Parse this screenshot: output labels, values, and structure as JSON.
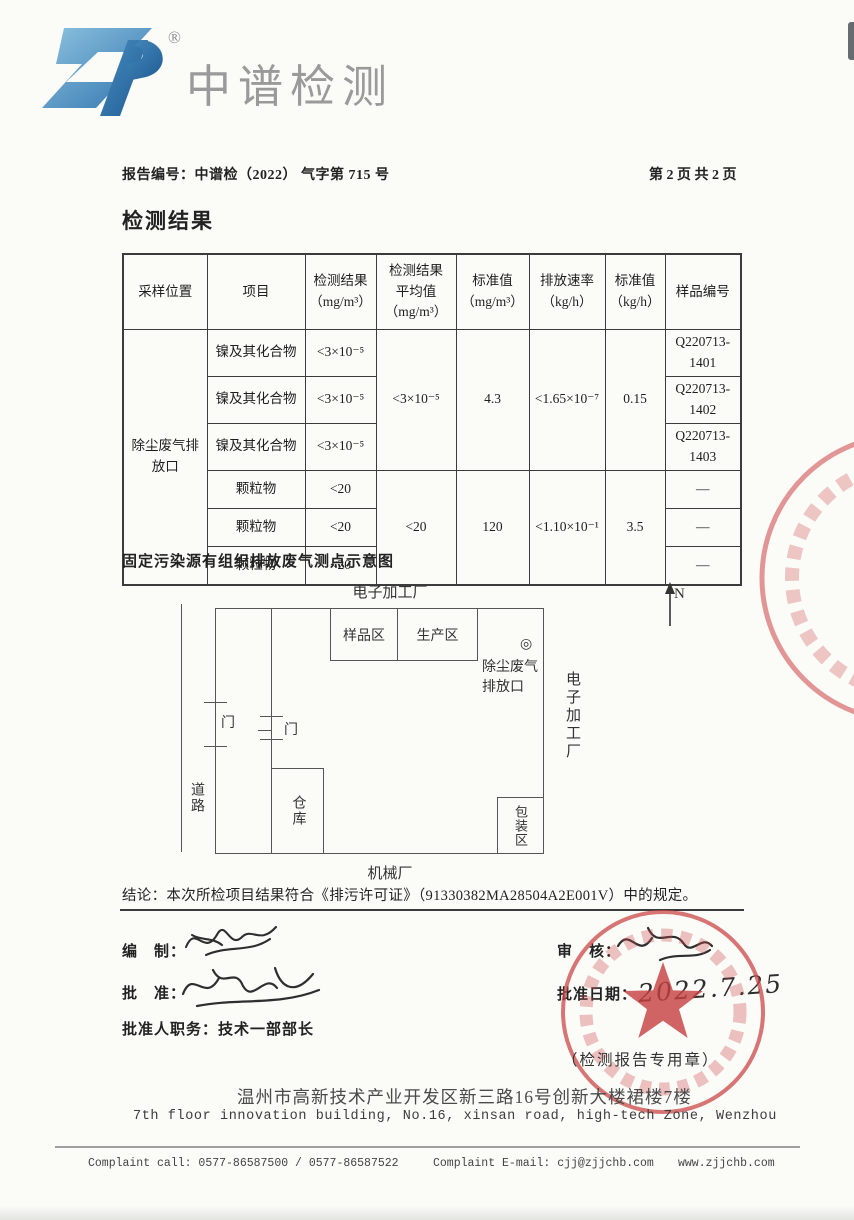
{
  "brand": {
    "name": "中谱检测",
    "registered_mark": "®"
  },
  "header": {
    "report_no": "报告编号：中谱检（2022） 气字第 715 号",
    "page_info": "第 2 页 共 2 页"
  },
  "results": {
    "title": "检测结果"
  },
  "results_table": {
    "headers": {
      "location": "采样位置",
      "item": "项目",
      "result_l1": "检测结果",
      "result_l2": "（mg/m³）",
      "avg_l1": "检测结果",
      "avg_l2": "平均值",
      "avg_l3": "（mg/m³）",
      "std_mg_l1": "标准值",
      "std_mg_l2": "（mg/m³）",
      "rate_l1": "排放速率",
      "rate_l2": "（kg/h）",
      "std_kg_l1": "标准值",
      "std_kg_l2": "（kg/h）",
      "sample": "样品编号"
    },
    "location": "除尘废气排放口",
    "groups": [
      {
        "item": "镍及其化合物",
        "results": [
          "<3×10⁻⁵",
          "<3×10⁻⁵",
          "<3×10⁻⁵"
        ],
        "average": "<3×10⁻⁵",
        "standard_mg": "4.3",
        "rate": "<1.65×10⁻⁷",
        "standard_kg": "0.15",
        "samples": [
          "Q220713-1401",
          "Q220713-1402",
          "Q220713-1403"
        ]
      },
      {
        "item": "颗粒物",
        "results": [
          "<20",
          "<20",
          "<20"
        ],
        "average": "<20",
        "standard_mg": "120",
        "rate": "<1.10×10⁻¹",
        "standard_kg": "3.5",
        "samples": [
          "—",
          "—",
          "—"
        ]
      }
    ]
  },
  "diagram": {
    "title": "固定污染源有组织排放废气测点示意图",
    "north_label": "N",
    "top_factory_label": "电子加工厂",
    "sample_area": "样品区",
    "production_area": "生产区",
    "outlet_symbol": "◎",
    "outlet_label_line1": "除尘废气",
    "outlet_label_line2": "排放口",
    "right_factory_label": "电子加工厂",
    "road_label": "道路",
    "gate_label_1": "门",
    "gate_label_2": "门",
    "warehouse_label": "仓库",
    "packing_label": "包装区",
    "bottom_factory_label": "机械厂"
  },
  "conclusion": "结论：本次所检项目结果符合《排污许可证》（91330382MA28504A2E001V）中的规定。",
  "signoff": {
    "prepare_label": "编　制：",
    "approve_label": "批　准：",
    "approver_title_label": "批准人职务：",
    "approver_title": "技术一部部长",
    "review_label": "审　核：",
    "approve_date_label": "批准日期：",
    "approve_date": "2022.7.25",
    "stamp_caption": "（检测报告专用章）"
  },
  "footer": {
    "address_cn": "温州市高新技术产业开发区新三路16号创新大楼裙楼7楼",
    "address_en": "7th floor innovation building, No.16, xinsan road, high-tech Zone, Wenzhou",
    "complaint_call": "Complaint call: 0577-86587500 / 0577-86587522",
    "complaint_email": "Complaint E-mail: cjj@zjjchb.com",
    "website": "www.zjjchb.com"
  }
}
